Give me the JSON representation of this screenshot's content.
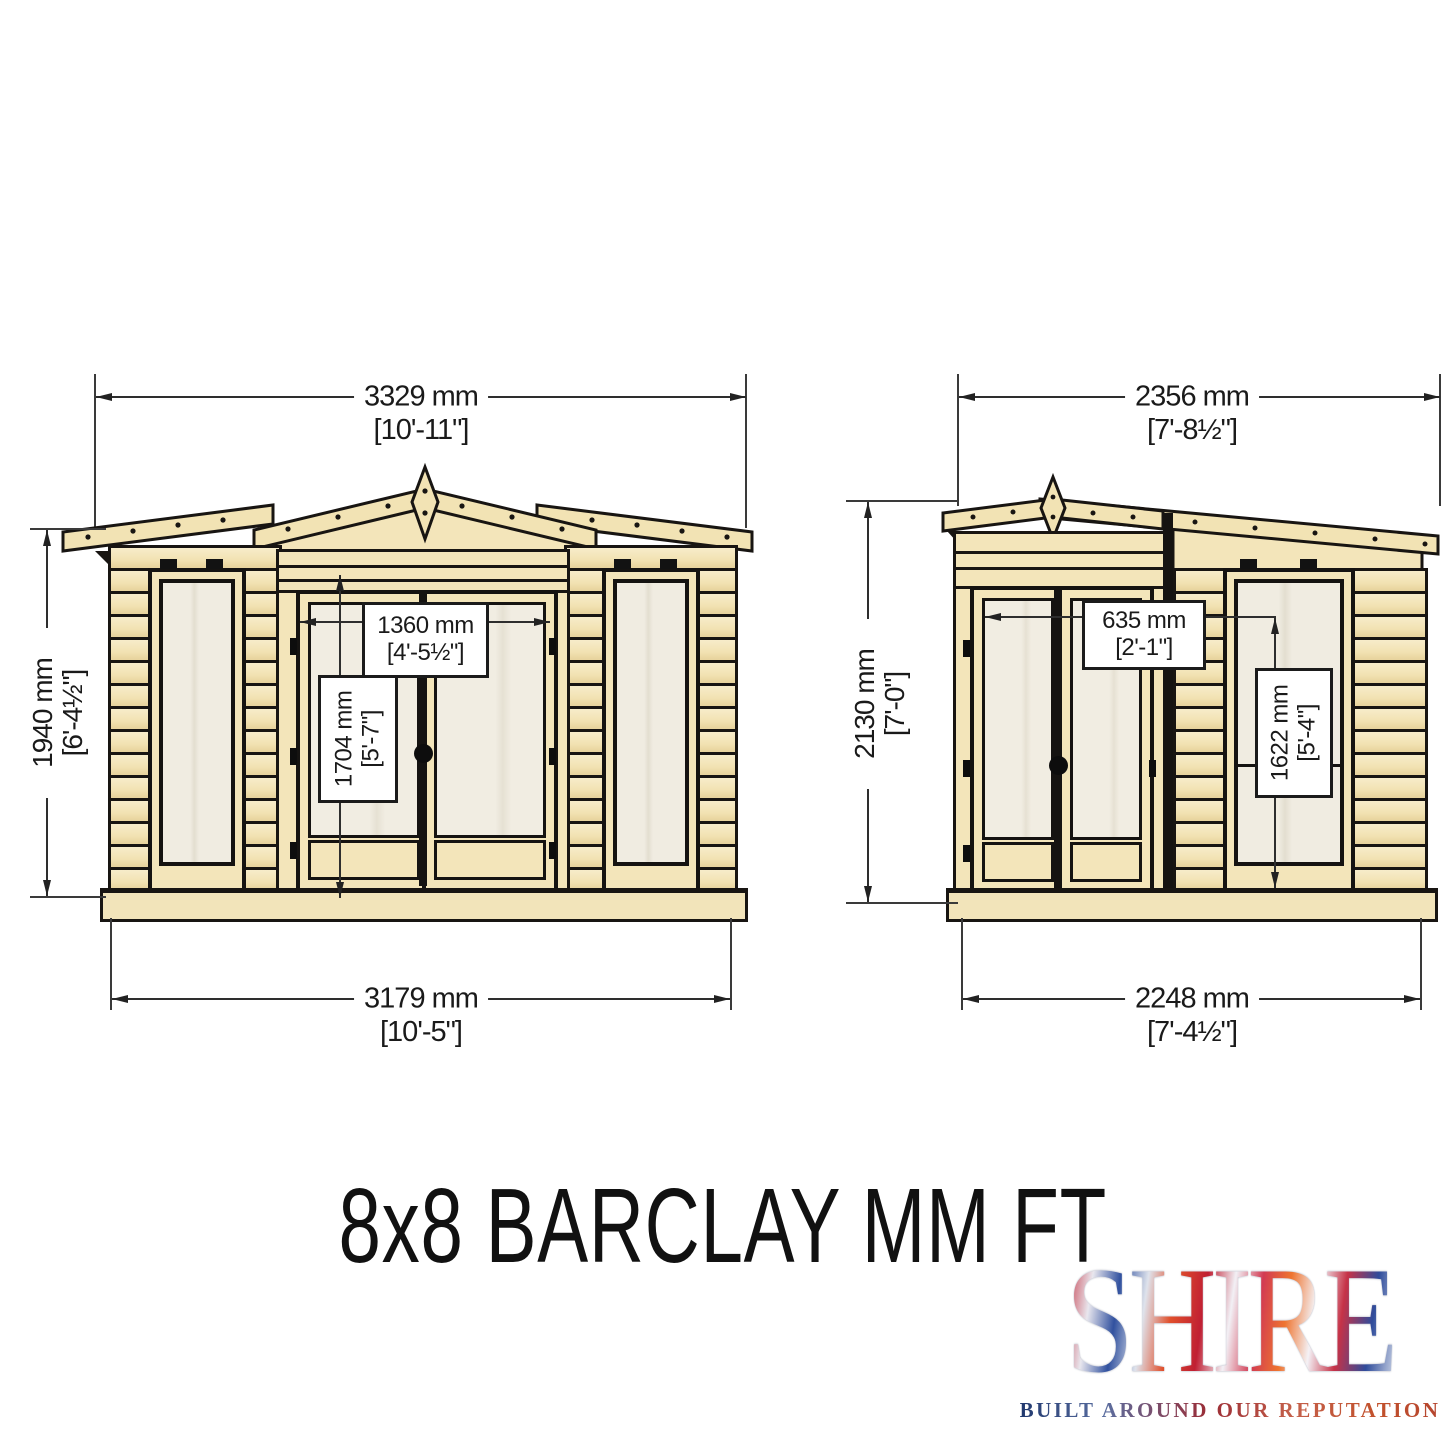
{
  "title": "8x8 BARCLAY MM FT",
  "logo": {
    "brand": "SHIRE",
    "tagline": "BUILT AROUND OUR REPUTATION"
  },
  "front_elevation": {
    "overall_width": {
      "mm": "3329 mm",
      "ft": "[10'-11\"]"
    },
    "overall_height": {
      "mm": "1940 mm",
      "ft": "[6'-4½\"]"
    },
    "door_width": {
      "mm": "1360 mm",
      "ft": "[4'-5½\"]"
    },
    "door_height": {
      "mm": "1704 mm",
      "ft": "[5'-7\"]"
    },
    "base_width": {
      "mm": "3179 mm",
      "ft": "[10'-5\"]"
    }
  },
  "side_elevation": {
    "overall_width": {
      "mm": "2356 mm",
      "ft": "[7'-8½\"]"
    },
    "overall_height": {
      "mm": "2130 mm",
      "ft": "[7'-0\"]"
    },
    "door_width": {
      "mm": "635 mm",
      "ft": "[2'-1\"]"
    },
    "window_height": {
      "mm": "1622 mm",
      "ft": "[5'-4\"]"
    },
    "base_width": {
      "mm": "2248 mm",
      "ft": "[7'-4½\"]"
    }
  },
  "colors": {
    "wood": "#f3e5ba",
    "wood_light": "#f7ecca",
    "glass": "#f0ece1",
    "outline": "#181512",
    "dimension": "#2e2e2e"
  }
}
